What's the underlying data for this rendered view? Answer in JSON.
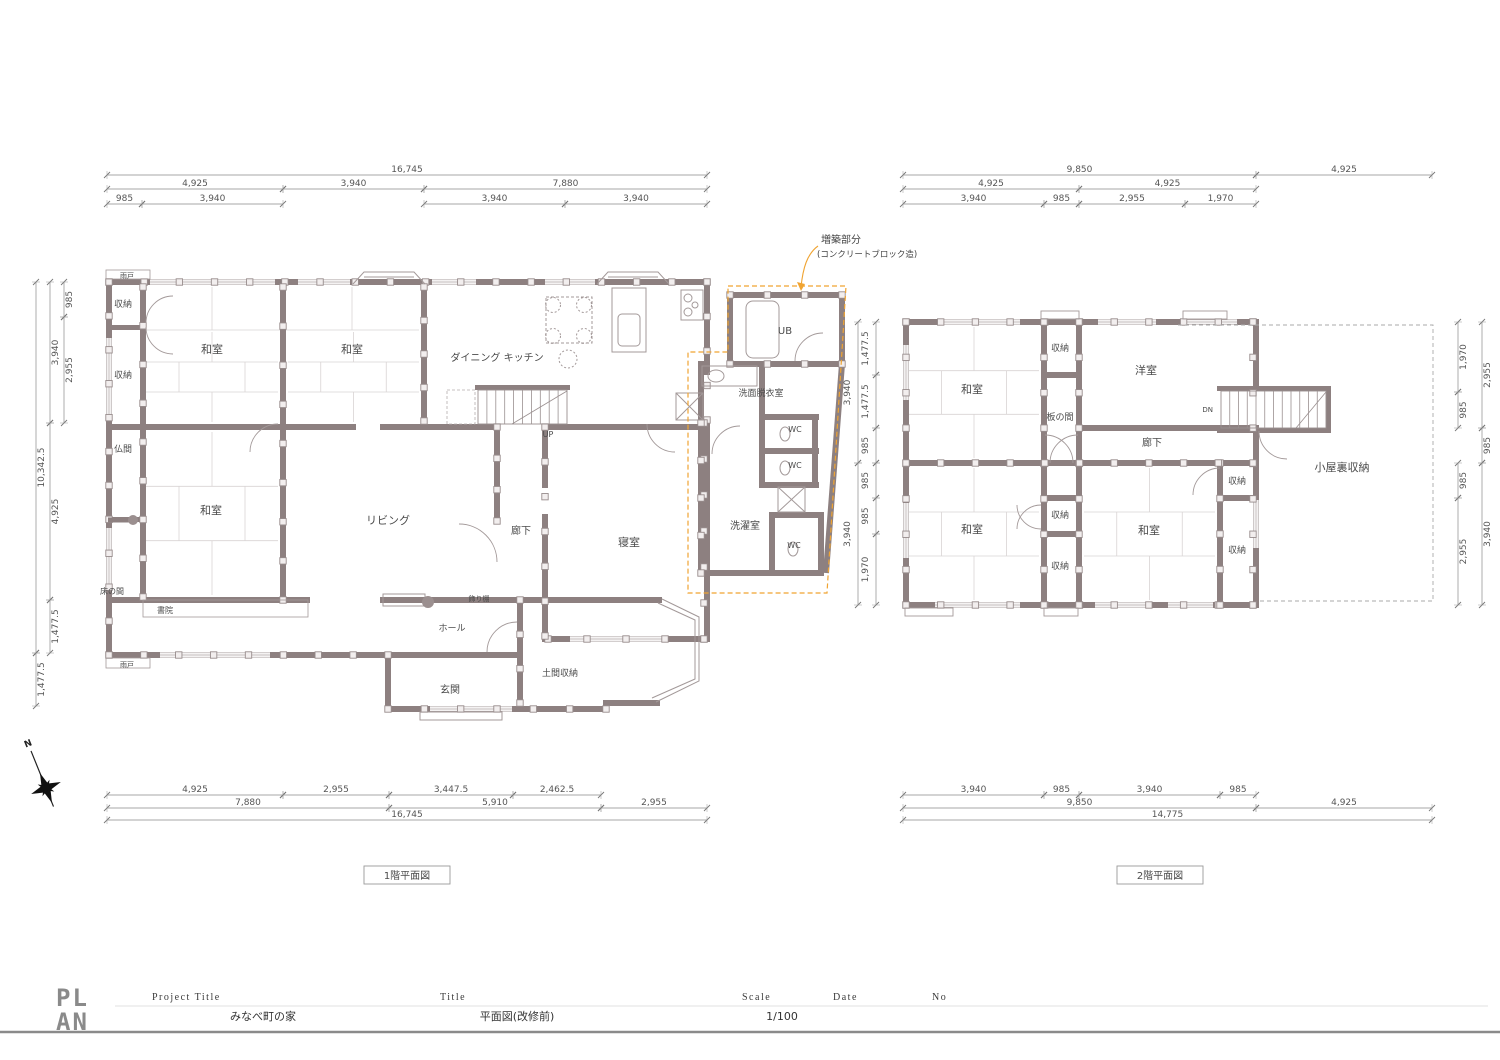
{
  "colors": {
    "wall": "#8d8080",
    "thin_line": "#9a9090",
    "tatami_line": "#d9d4d4",
    "dim_line": "#8a8a8a",
    "addition_outline": "#f0a432",
    "background": "#ffffff"
  },
  "plan1": {
    "title": "1階平面図",
    "rooms": {
      "amado_top": "雨戸",
      "shuno_1": "収納",
      "shuno_2": "収納",
      "butsuma": "仏間",
      "washitsu_1": "和室",
      "washitsu_2": "和室",
      "dining_kitchen": "ダイニング キッチン",
      "washitsu_3": "和室",
      "living": "リビング",
      "tokonoma": "床の間",
      "shoin": "書院",
      "kazaridana": "飾り棚",
      "roka": "廊下",
      "shinshitsu": "寝室",
      "hall": "ホール",
      "genkan": "玄関",
      "doma_shuno": "土間収納",
      "amado_bottom": "雨戸",
      "ub": "UB",
      "senmen": "洗面脱衣室",
      "wc_1": "WC",
      "wc_2": "WC",
      "wc_3": "WC",
      "sentaku": "洗濯室",
      "up": "UP"
    },
    "annotation": {
      "line1": "増築部分",
      "line2": "(コンクリートブロック造)"
    },
    "dims_top": [
      [
        "16,745"
      ],
      [
        "4,925",
        "3,940",
        "7,880"
      ],
      [
        "985",
        "3,940",
        "3,940",
        "3,940"
      ]
    ],
    "dims_bottom": [
      [
        "4,925",
        "2,955",
        "3,447.5",
        "2,462.5"
      ],
      [
        "7,880",
        "5,910",
        "2,955"
      ],
      [
        "16,745"
      ]
    ],
    "dims_left": [
      [
        "10,342.5",
        "1,477.5"
      ],
      [
        "3,940",
        "4,925",
        "1,477.5"
      ],
      [
        "985",
        "2,955"
      ]
    ]
  },
  "plan2": {
    "title": "2階平面図",
    "rooms": {
      "washitsu_1": "和室",
      "shuno_1": "収納",
      "yoshitsu": "洋室",
      "itanoma": "板の間",
      "roka": "廊下",
      "dn": "DN",
      "washitsu_2": "和室",
      "shuno_2": "収納",
      "shuno_3": "収納",
      "washitsu_3": "和室",
      "shuno_4": "収納",
      "shuno_5": "収納",
      "koyaura": "小屋裏収納"
    },
    "dims_top": [
      [
        "9,850",
        "4,925"
      ],
      [
        "4,925",
        "4,925"
      ],
      [
        "3,940",
        "985",
        "2,955",
        "1,970"
      ]
    ],
    "dims_bottom": [
      [
        "3,940",
        "985",
        "3,940",
        "985"
      ],
      [
        "9,850",
        "4,925"
      ],
      [
        "14,775"
      ]
    ],
    "dims_left": [
      [
        "3,940",
        "3,940"
      ],
      [
        "1,477.5",
        "1,477.5",
        "985",
        "985",
        "985",
        "1,970"
      ]
    ],
    "dims_right": [
      [
        "1,970",
        "985",
        "985",
        "2,955"
      ],
      [
        "2,955",
        "985",
        "3,940"
      ]
    ]
  },
  "titleblock": {
    "logo_top": "PL",
    "logo_bottom": "AN",
    "project_title_label": "Project Title",
    "project_title": "みなべ町の家",
    "title_label": "Title",
    "title": "平面図(改修前)",
    "scale_label": "Scale",
    "scale": "1/100",
    "date_label": "Date",
    "no_label": "No"
  },
  "north": {
    "label": "N"
  }
}
